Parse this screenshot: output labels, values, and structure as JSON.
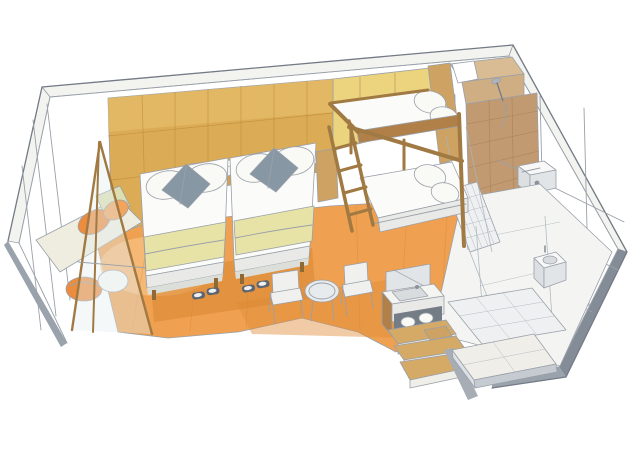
{
  "illustration": {
    "subject": "hand-drawn isometric sketch of a hotel guest room",
    "style": "colored-pencil and watercolor on white paper",
    "items": [
      "headboard-panel-wall",
      "accent-wall",
      "window-bench-nook",
      "glass-partition",
      "twin-bed-left",
      "twin-bed-right",
      "gray-accent-cushions",
      "bed-runners",
      "nightstand",
      "bunk-bed",
      "bunk-ladder",
      "shower-room",
      "shower-head",
      "shower-floor-grate",
      "closet-shelves",
      "safe",
      "vanity-sink",
      "mirror",
      "towel-shelf",
      "step-shelves",
      "hand-basin",
      "toilet",
      "entry-tile-floor",
      "entry-step",
      "round-table",
      "chairs",
      "slippers",
      "wood-floor"
    ]
  },
  "palette": {
    "paper": "#ffffff",
    "wall_band": "#f3f3f0",
    "skirting": "#9aa2ac",
    "skirting_dark": "#848d97",
    "mustard": "#dcab55",
    "mustard_light": "#e8c272",
    "headboard_band": "#f4f2ec",
    "trim_wood": "#cda158",
    "accent_yellow": "#ecd37d",
    "wood": "#b08048",
    "wood_dark": "#8f6a36",
    "wood_light": "#cda262",
    "floor_light": "#f7c488",
    "floor_mid": "#efa050",
    "floor_deep": "#e08b38",
    "floor_shadow": "#d8852f",
    "bed_white": "#fbfbf9",
    "bed_side": "#e9eae7",
    "bed_base": "#dcdeda",
    "runner": "#e7e3a7",
    "pillow_white": "#f9f9f6",
    "pillow_gray": "#8797a4",
    "pillow_gray_dark": "#64798a",
    "cushion_orange": "#ec8c3e",
    "cushion_orange2": "#f2a45c",
    "bench_cream": "#efece0",
    "bench_green": "#dcdfb2",
    "glass": "#e4edf1",
    "tile_tan": "#c19a71",
    "tile_back": "#cfae84",
    "tile_rim": "#d9bc93",
    "bath_floor": "#f4f5f3",
    "mat": "#eef0f1",
    "entry_tile": "#eff0f1",
    "entry_front": "#c5cbd1",
    "entry_side": "#dde1e5",
    "threshold": "#a6adb5",
    "mirror": "#e2e5e8",
    "counter": "#f4f4f1",
    "sink": "#d8dcdf",
    "shelf_dark": "#747c85",
    "step_wood": "#d5aa66",
    "step_riser": "#f0eee8",
    "fixture": "#f7f8f7",
    "fixture_shade": "#dce0e2",
    "table_top": "#e8ebed",
    "chair_seat": "#f0f1ef"
  }
}
